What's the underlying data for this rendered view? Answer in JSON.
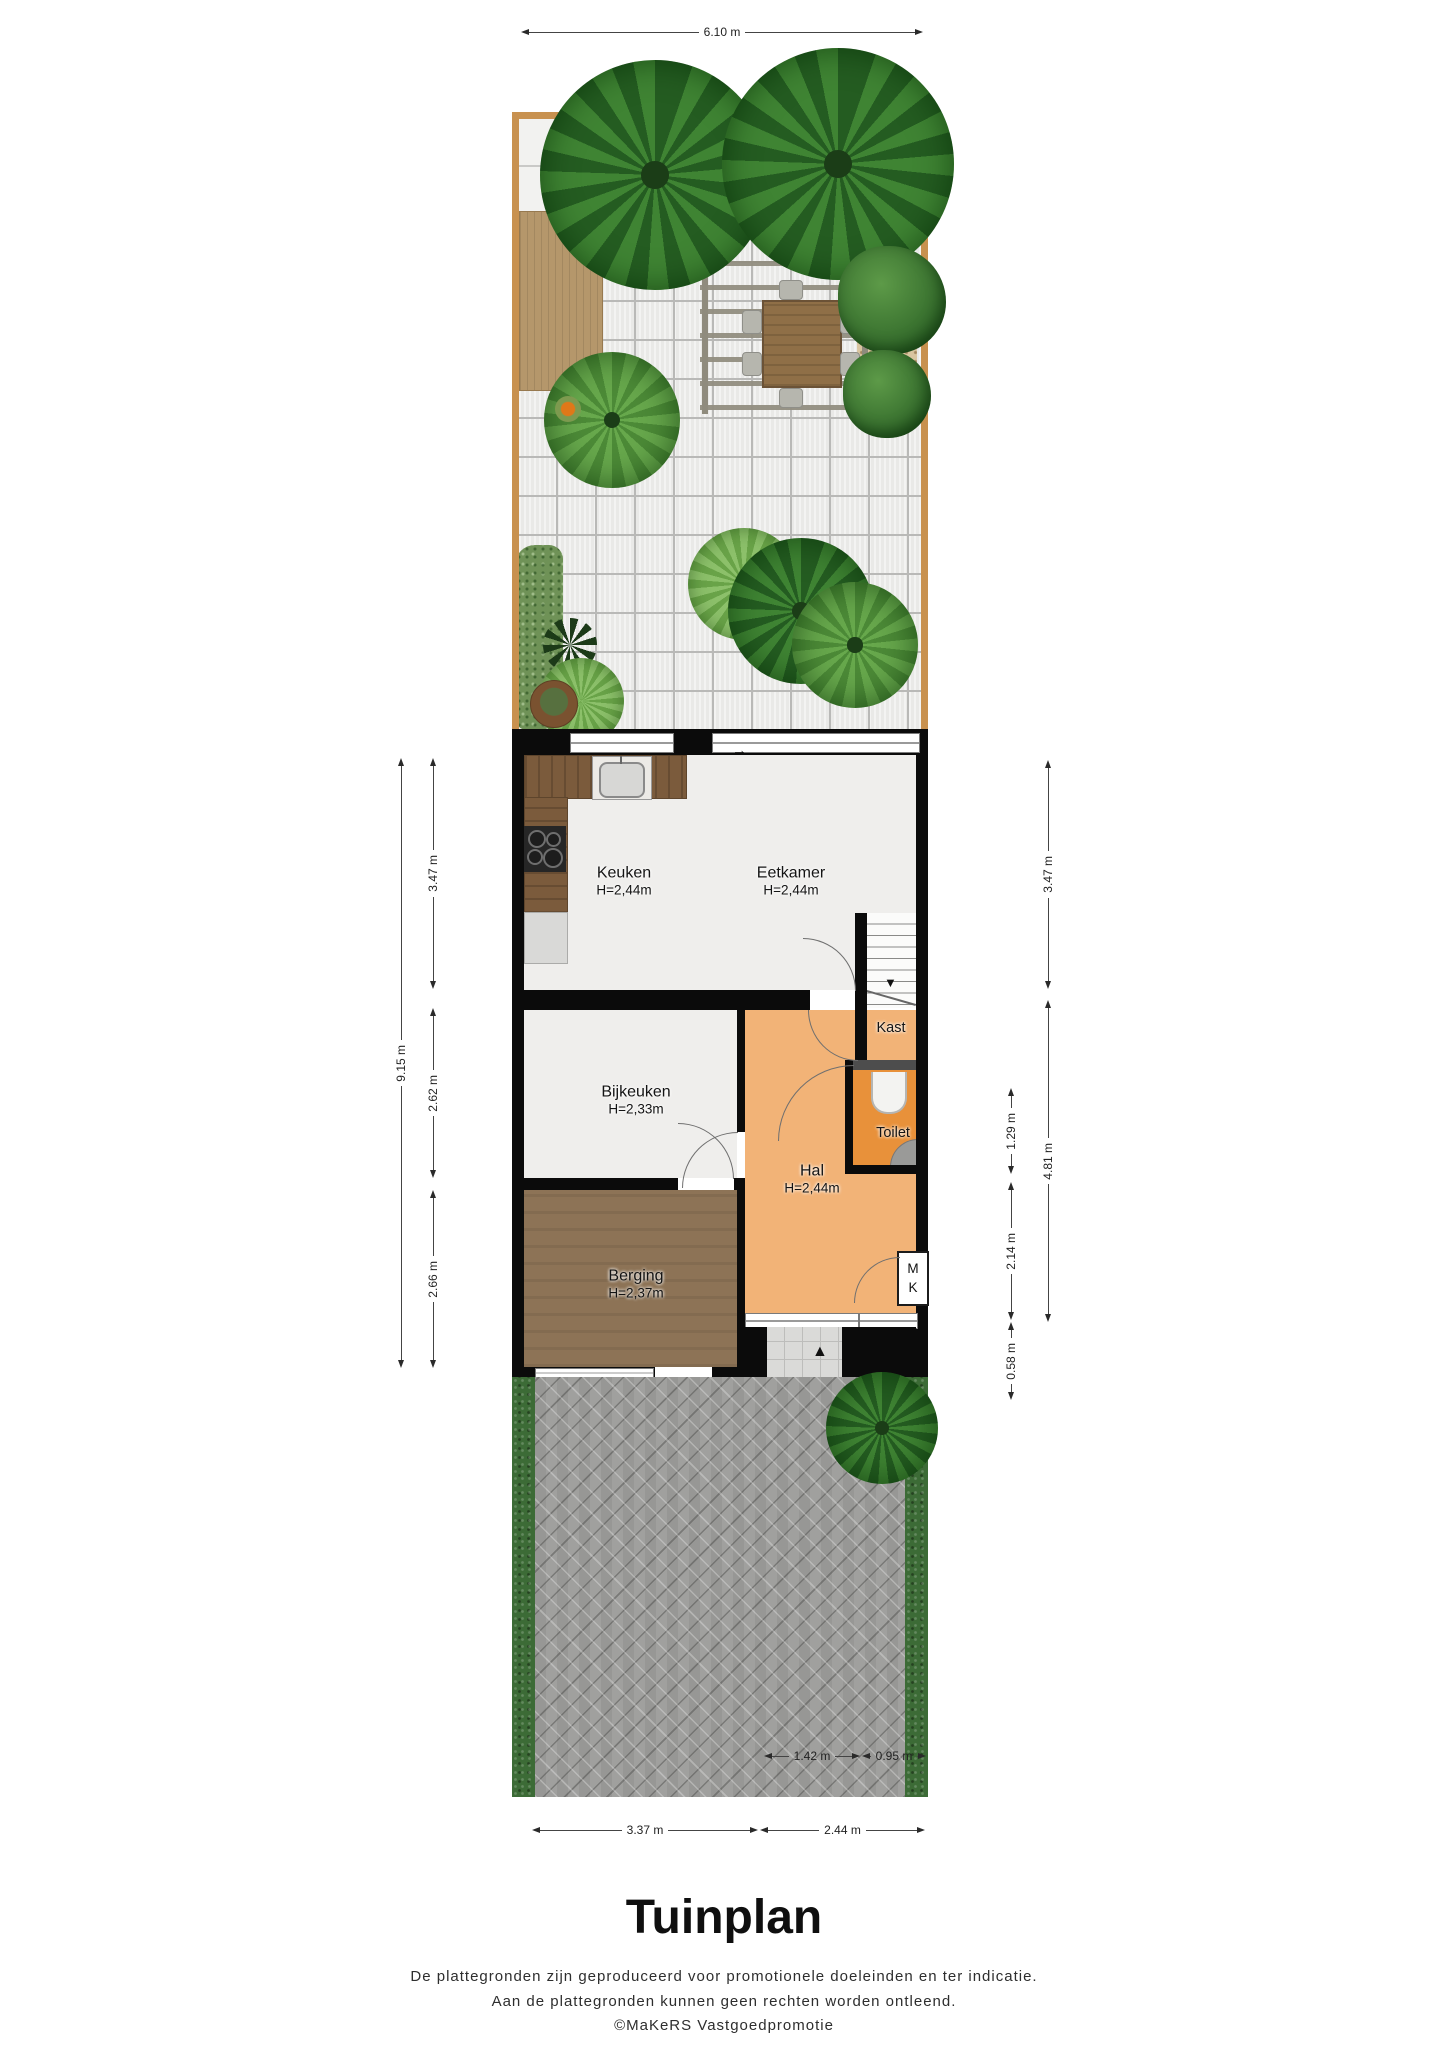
{
  "title": "Tuinplan",
  "footer": {
    "line1": "De plattegronden zijn geproduceerd voor promotionele doeleinden en ter indicatie.",
    "line2": "Aan de plattegronden kunnen geen rechten worden ontleend.",
    "line3": "©MaKeRS Vastgoedpromotie"
  },
  "rooms": {
    "keuken": {
      "name": "Keuken",
      "height": "H=2,44m"
    },
    "eetkamer": {
      "name": "Eetkamer",
      "height": "H=2,44m"
    },
    "kast": {
      "name": "Kast"
    },
    "bijkeuken": {
      "name": "Bijkeuken",
      "height": "H=2,33m"
    },
    "toilet": {
      "name": "Toilet"
    },
    "hal": {
      "name": "Hal",
      "height": "H=2,44m"
    },
    "berging": {
      "name": "Berging",
      "height": "H=2,37m"
    },
    "meterkast": {
      "line1": "M",
      "line2": "K"
    }
  },
  "dimensions": {
    "top": "6.10 m",
    "left_outer": "9.15 m",
    "left_inner": [
      "3.47 m",
      "2.62 m",
      "2.66 m"
    ],
    "right_inner": [
      "1.29 m",
      "2.14 m",
      "0.58 m"
    ],
    "right_outer": [
      "3.47 m",
      "4.81 m"
    ],
    "bottom_row1": [
      "1.42 m",
      "0.95 m"
    ],
    "bottom_row2": [
      "3.37 m",
      "2.44 m"
    ]
  },
  "icons": {
    "entrance_arrow": "▲",
    "stairs_down_arrow": "▼",
    "sliding_door_arrow": "→"
  },
  "colors": {
    "wall": "#0B0B0B",
    "hal_orange": "#F2B377",
    "toilet_orange": "#E8913A",
    "berging_brown": "#8D7356",
    "counter_wood": "#7B5B3C",
    "garden_fence": "#C8914F",
    "deck_wood": "#B5976B",
    "patio_tile": "#E9E9E7",
    "paving_gray": "#A0A09E",
    "hedge_green": "#3C6B36",
    "floor_light": "#EFEEEC"
  }
}
